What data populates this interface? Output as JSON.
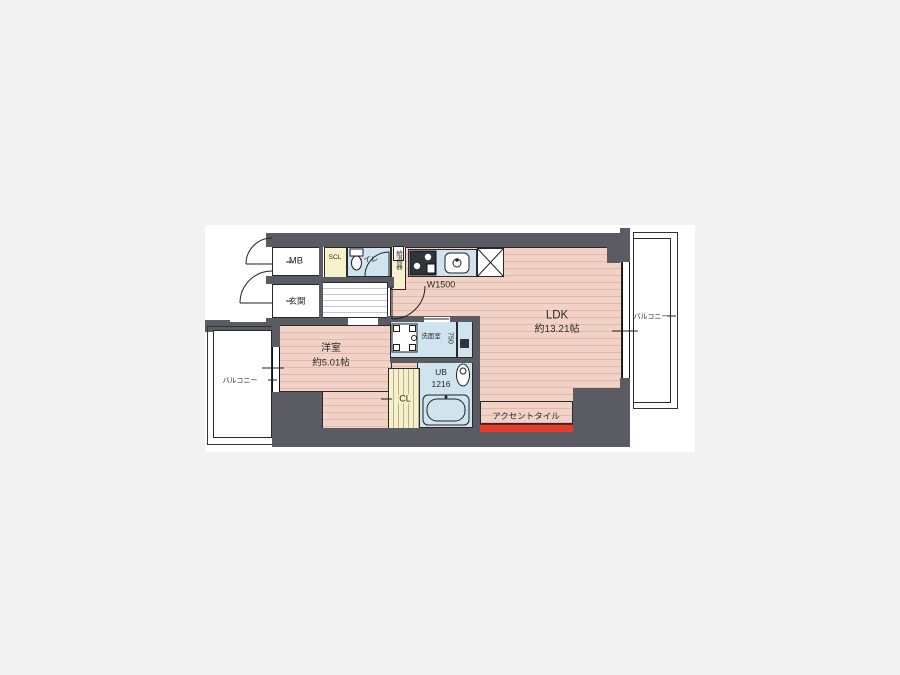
{
  "floorplan": {
    "labels": {
      "mb": "MB",
      "genkan": "玄関",
      "scl": "SCL",
      "toilet": "トイレ",
      "water_heater": "給湯器",
      "kitchen_width": "W1500",
      "ldk_name": "LDK",
      "ldk_size": "約13.21帖",
      "bedroom_name": "洋室",
      "bedroom_size": "約5.01帖",
      "washroom": "洗面室",
      "washroom_width": "750",
      "bath_name": "UB",
      "bath_size": "1216",
      "closet": "CL",
      "balcony_left": "バルコニー",
      "balcony_right": "バルコニー",
      "accent_tile": "アクセントタイル"
    },
    "colors": {
      "wall": "#5b5c63",
      "room_pink": "#f2d2c6",
      "room_blue": "#cfe4ee",
      "room_yellow": "#f6f1ca",
      "accent_red": "#e63c2d",
      "line": "#222222",
      "canvas": "#ffffff",
      "page_background": "#f2f2f2"
    }
  }
}
